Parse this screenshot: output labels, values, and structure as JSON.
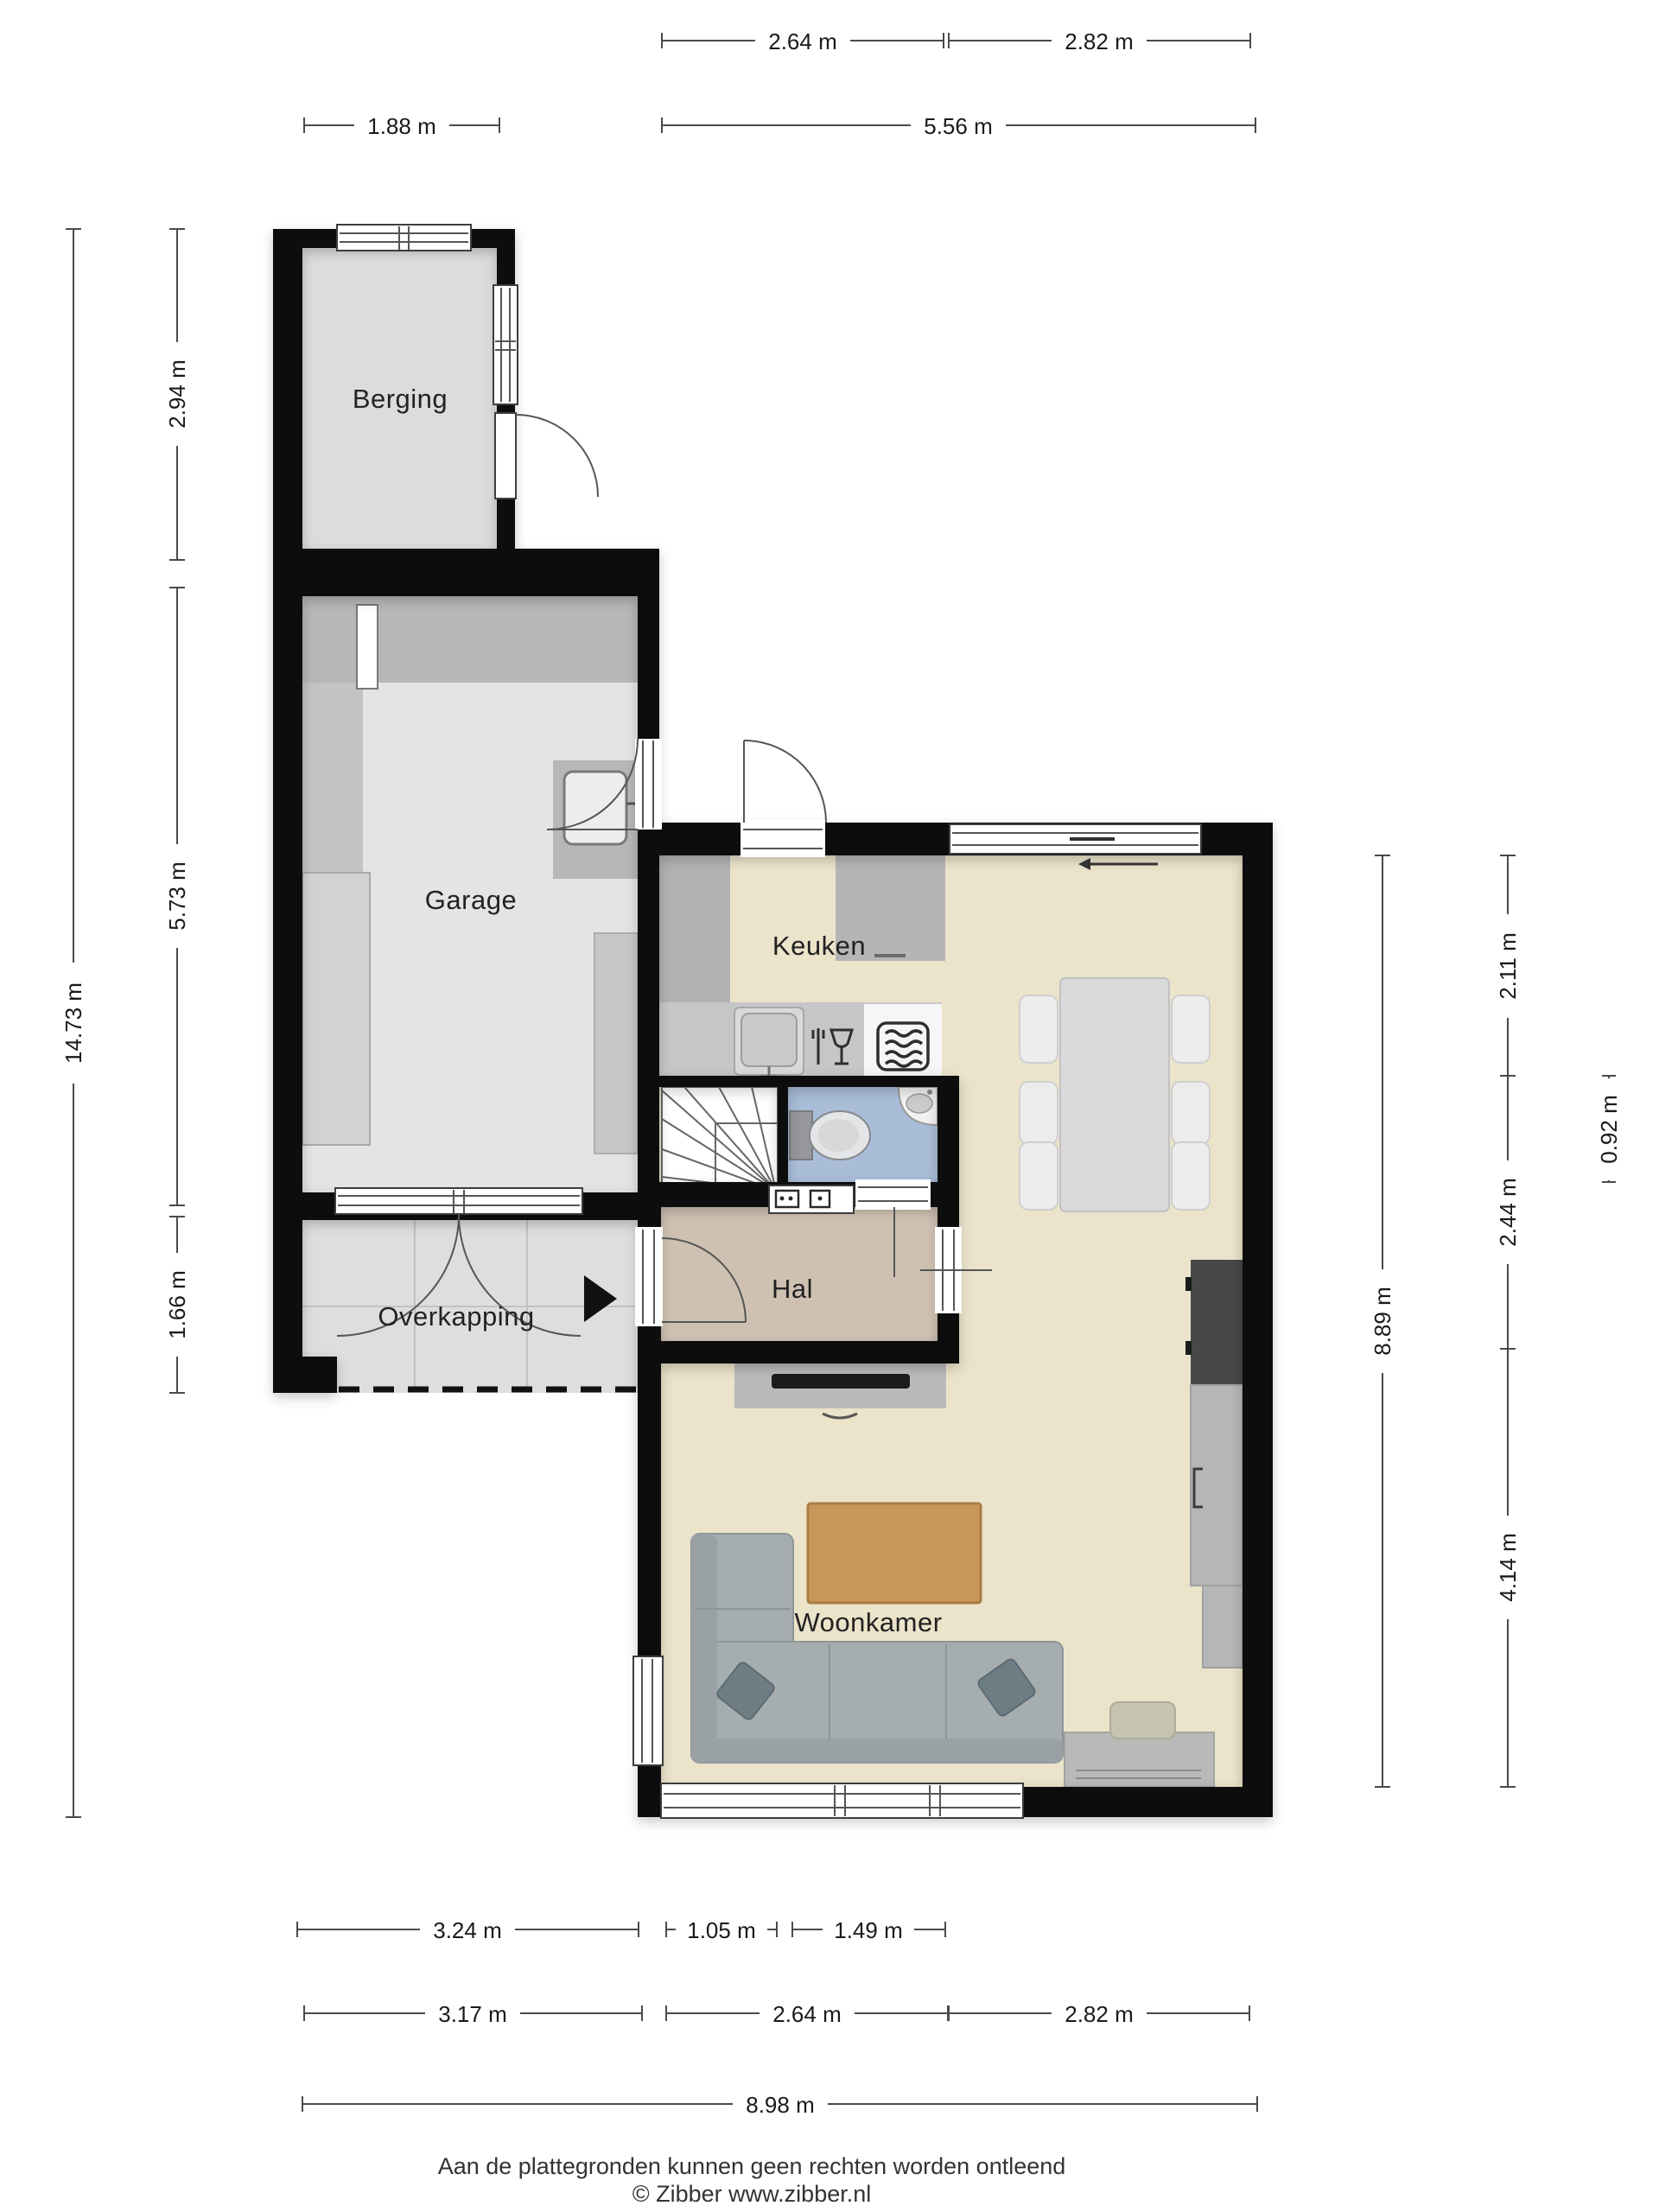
{
  "floorplan": {
    "rooms": {
      "berging": "Berging",
      "garage": "Garage",
      "keuken": "Keuken",
      "hal": "Hal",
      "overkapping": "Overkapping",
      "woonkamer": "Woonkamer"
    },
    "dims": {
      "top_row1": [
        "2.64 m",
        "2.82 m"
      ],
      "top_row2": [
        "1.88 m",
        "5.56 m"
      ],
      "left_total": "14.73 m",
      "left": [
        "2.94 m",
        "5.73 m",
        "1.66 m"
      ],
      "right_total": "8.89 m",
      "right": [
        "2.11 m",
        "2.44 m",
        "4.14 m"
      ],
      "right_toilet": "0.92 m",
      "bottom_row1": [
        "3.24 m",
        "1.05 m",
        "1.49 m"
      ],
      "bottom_row2": [
        "3.17 m",
        "2.64 m",
        "2.82 m"
      ],
      "bottom_total": "8.98 m"
    },
    "footer": {
      "disclaimer": "Aan de plattegronden kunnen geen rechten worden ontleend",
      "credit": "© Zibber www.zibber.nl"
    },
    "colors": {
      "wall": "#0f0f0f",
      "floor_living": "#ebe3ca",
      "floor_hal": "#cfc1b2",
      "floor_toilet": "#a9bdd8",
      "floor_storage": "#dcdcdc",
      "floor_garage": "#e4e4e4",
      "floor_canopy": "#dedede",
      "counter_gray": "#c6c6c8",
      "furniture_gray": "#b9b9bb",
      "cabinet_dark": "#48484a",
      "sofa": "#a6adaf",
      "table_wood": "#c9965a",
      "dim_line": "#4a4a4a"
    }
  }
}
